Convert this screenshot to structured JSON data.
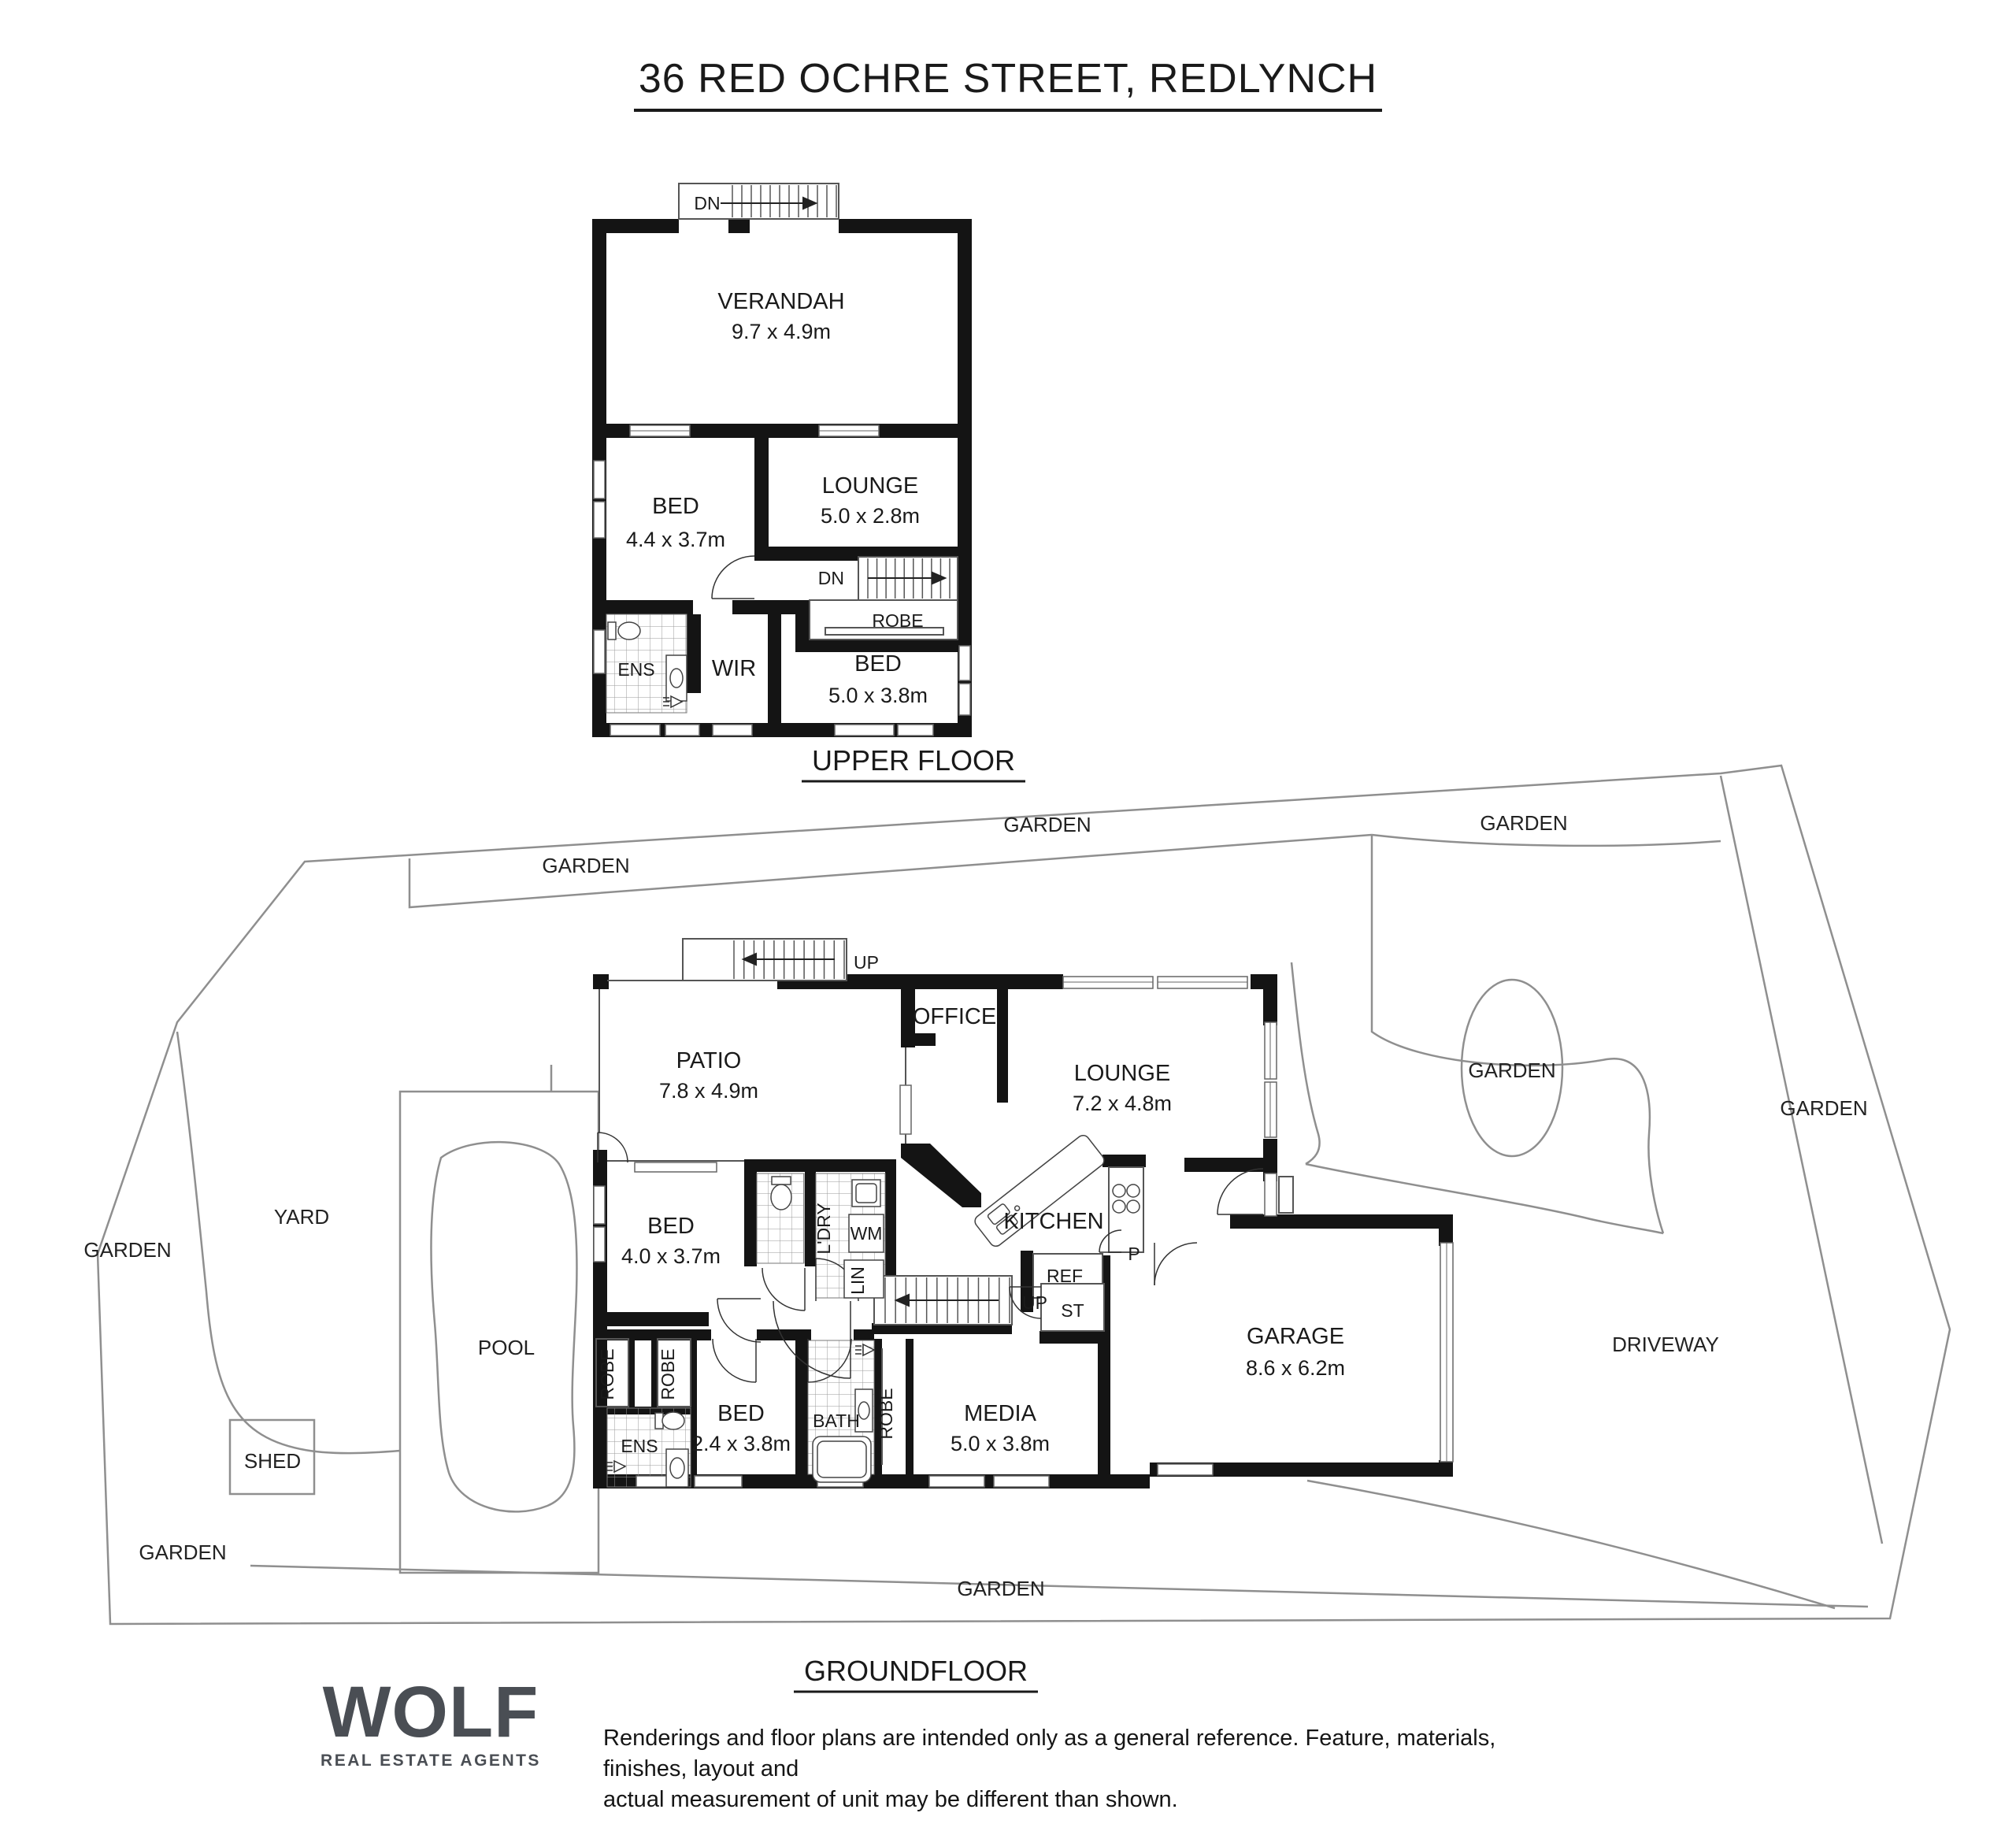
{
  "title": "36 RED OCHRE STREET, REDLYNCH",
  "upper": {
    "floor_label": "UPPER FLOOR",
    "stairs": {
      "dn_top": "DN",
      "dn_inner": "DN"
    },
    "verandah": {
      "name": "VERANDAH",
      "dims": "9.7 x 4.9m"
    },
    "bed1": {
      "name": "BED",
      "dims": "4.4 x 3.7m"
    },
    "lounge": {
      "name": "LOUNGE",
      "dims": "5.0 x 2.8m"
    },
    "bed2": {
      "name": "BED",
      "dims": "5.0 x 3.8m"
    },
    "ens": "ENS",
    "wir": "WIR",
    "robe": "ROBE"
  },
  "ground": {
    "floor_label": "GROUNDFLOOR",
    "stairs": {
      "up_top": "UP",
      "up_inner": "UP"
    },
    "patio": {
      "name": "PATIO",
      "dims": "7.8 x 4.9m"
    },
    "office": "OFFICE",
    "lounge": {
      "name": "LOUNGE",
      "dims": "7.2 x 4.8m"
    },
    "kitchen": "KITCHEN",
    "pantry": "P",
    "fridge": "REF",
    "store": "ST",
    "bed3": {
      "name": "BED",
      "dims": "4.0 x 3.7m"
    },
    "laundry": "L'DRY",
    "wm": "WM",
    "linen": "LIN",
    "bed4": {
      "name": "BED",
      "dims": "2.4 x 3.8m"
    },
    "bath": "BATH",
    "ens": "ENS",
    "media": {
      "name": "MEDIA",
      "dims": "5.0 x 3.8m"
    },
    "garage": {
      "name": "GARAGE",
      "dims": "8.6 x 6.2m"
    },
    "robes": [
      "ROBE",
      "ROBE",
      "ROBE"
    ]
  },
  "site": {
    "gardens": [
      "GARDEN",
      "GARDEN",
      "GARDEN",
      "GARDEN",
      "GARDEN",
      "GARDEN",
      "GARDEN",
      "GARDEN"
    ],
    "yard": "YARD",
    "pool": "POOL",
    "shed": "SHED",
    "driveway": "DRIVEWAY"
  },
  "footer": {
    "logo": "WOLF",
    "tagline": "REAL ESTATE AGENTS",
    "disclaimer_line1": "Renderings and floor plans are intended only as a general reference. Feature, materials, finishes, layout and",
    "disclaimer_line2": "actual measurement of unit may be different than shown."
  },
  "colors": {
    "wall": "#141414",
    "thin_line": "#555555",
    "site_line": "#8f8f8f",
    "logo_gray": "#4a4e54",
    "text": "#1a1a1a"
  }
}
